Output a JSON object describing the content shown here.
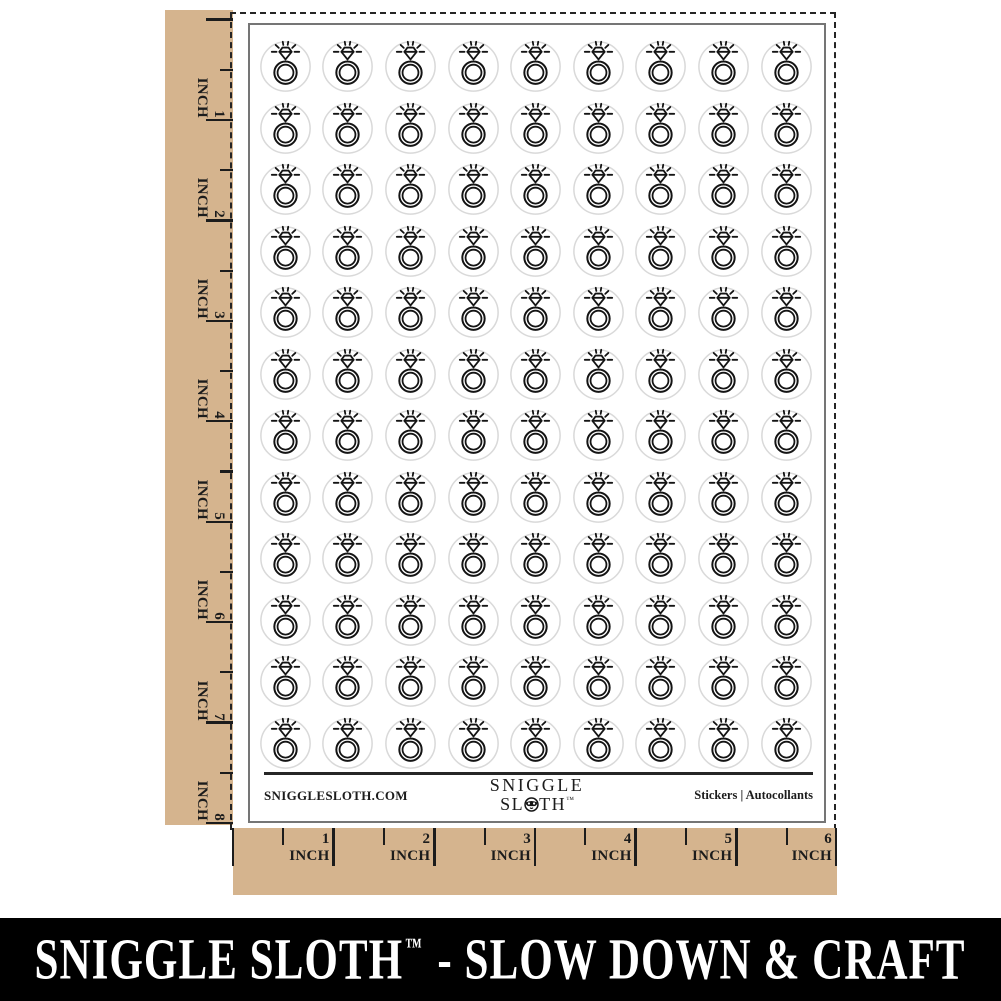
{
  "colors": {
    "tan": "#d5b48e",
    "ink": "#1c1c1c",
    "banner_bg": "#000000",
    "banner_text": "#ffffff",
    "ring": "#141414",
    "sticker_border": "#d9d9d9",
    "sheet_border": "#757575"
  },
  "left_ruler": {
    "unit": "INCH",
    "numbers": [
      1,
      2,
      3,
      4,
      5,
      6,
      7,
      8
    ]
  },
  "bottom_ruler": {
    "unit": "INCH",
    "numbers": [
      1,
      2,
      3,
      4,
      5,
      6
    ]
  },
  "sheet": {
    "grid": {
      "rows": 12,
      "cols": 9,
      "sticker_count": 108,
      "icon": "diamond-ring-icon"
    },
    "footer": {
      "website": "SNIGGLESLOTH.COM",
      "logo": {
        "line1": "SNIGGLE",
        "line2_start": "SL",
        "line2_end": "TH",
        "trademark": "™",
        "o_icon": "sloth-face-icon"
      },
      "right_label": "Stickers  |  Autocollants"
    }
  },
  "banner": {
    "brand": "SNIGGLE SLOTH",
    "trademark": "™",
    "tagline": "- SLOW DOWN & CRAFT"
  }
}
